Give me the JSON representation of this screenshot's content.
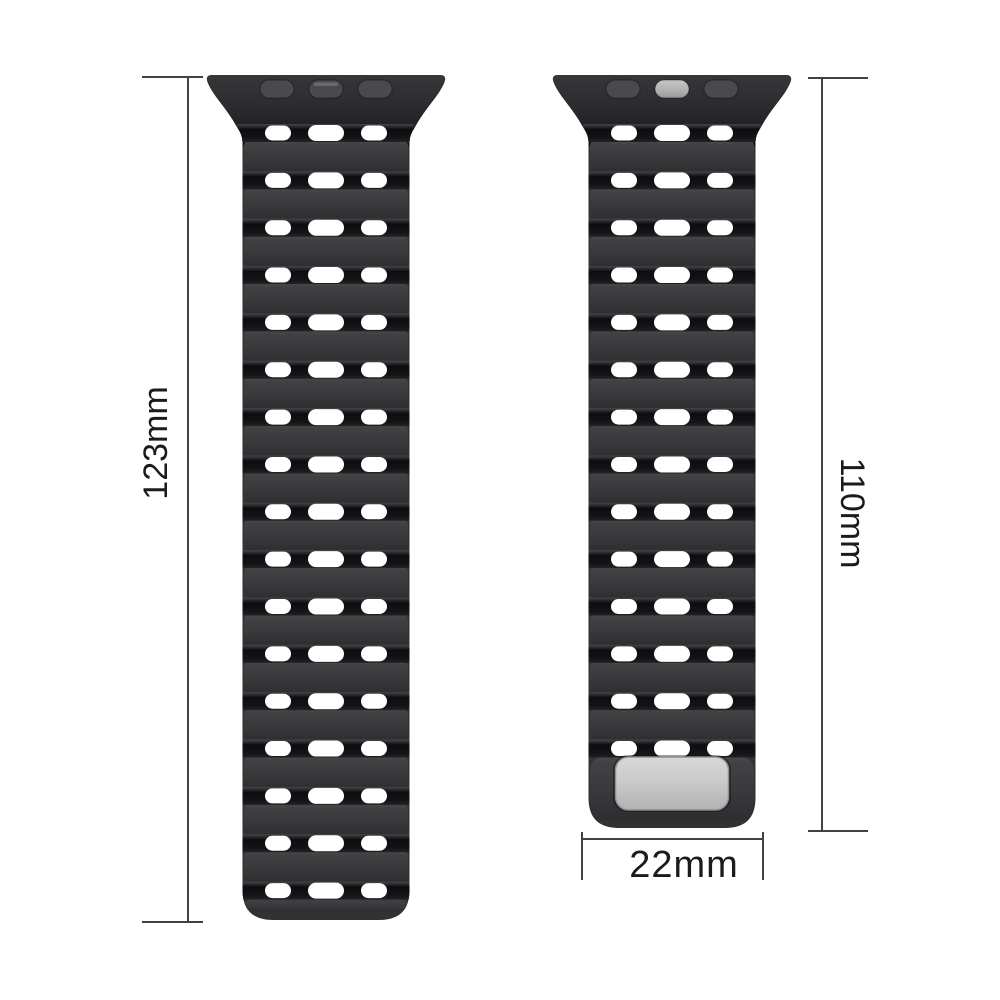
{
  "diagram": {
    "type": "product-dimension-diagram",
    "background": "#ffffff",
    "product": "perforated silicone watch strap, two views",
    "straps": [
      {
        "id": "left",
        "description": "long strap segment, back view",
        "rows": 17,
        "holes_per_row": 3,
        "connector_slots": 3,
        "center_slot_finish": "dark",
        "metal_plate": false
      },
      {
        "id": "right",
        "description": "short strap segment with metal magnetic plate",
        "rows": 14,
        "holes_per_row": 3,
        "connector_slots": 3,
        "center_slot_finish": "silver",
        "metal_plate": true
      }
    ],
    "colors": {
      "strap_body": "#323235",
      "segment_top": "#4a4a4d",
      "segment_bottom": "#2e2e31",
      "ridge_dark": "#0d0d10",
      "hole": "#ffffff",
      "connector_dark": "#161619",
      "slot_dark": "#4a4a4d",
      "slot_silver": "#b0b0b2",
      "plate": "#c9c9c9",
      "plate_border": "#8e8e90",
      "dimension_line": "#424242",
      "dimension_text": "#1b1b1b"
    }
  },
  "dimensions": {
    "left_length": "123mm",
    "right_length": "110mm",
    "width": "22mm"
  }
}
